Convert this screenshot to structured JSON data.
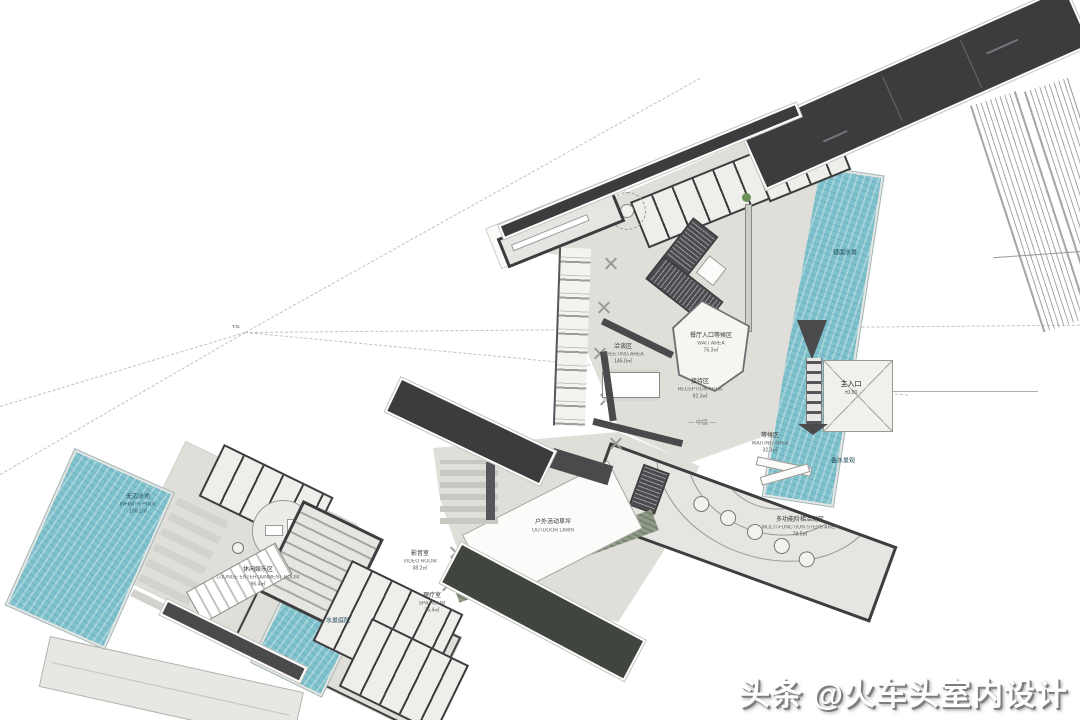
{
  "watermark": {
    "text": "头条 @火车头室内设计"
  },
  "colors": {
    "roof": "#3c3c3e",
    "wall": "#4a4a4c",
    "floor": "#e0ded9",
    "water": "#7fc1cc",
    "planting": "#8f9a87",
    "tree": "#6b9158"
  },
  "sight": {
    "point_label": "T.N."
  },
  "rooms": {
    "greeting": {
      "cn": "洽谈区",
      "en": "GREETING AREA",
      "area": "145.0㎡"
    },
    "wait": {
      "cn": "餐厅入口等候区",
      "en": "WAIT AREA",
      "area": "75.3㎡"
    },
    "reception": {
      "cn": "接待区",
      "en": "RECEPTION AREA",
      "area": "92.3㎡"
    },
    "atrium": {
      "cn": "— 中庭 —"
    },
    "entrance": {
      "cn": "主入口",
      "level": "±0.00"
    },
    "mirror_water": {
      "cn": "镜面水景"
    },
    "cascade_water": {
      "cn": "叠水景观"
    },
    "pool": {
      "cn": "无边泳池",
      "en": "INFINITY POOL",
      "area": "150.2㎡"
    },
    "lounge": {
      "cn": "休闲娱乐区",
      "en": "LOUNGE ENTERTAINMENT ROOM",
      "area": "96.4㎡"
    },
    "av_room": {
      "cn": "影音室",
      "en": "VIDEO ROOM",
      "area": "38.2㎡"
    },
    "spa": {
      "cn": "理疗室",
      "en": "SPA ROOM",
      "area": "26.4㎡"
    },
    "steps_hall": {
      "cn": "多功能阶梯活动区",
      "en": "MULTI-FUNCTION STEPS AREA",
      "area": "78.5㎡"
    },
    "waiting": {
      "cn": "等候区",
      "en": "WAITING AREA",
      "area": "32.3㎡"
    },
    "lawn": {
      "cn": "户外活动草坪",
      "en": "OUTDOOR LAWN"
    },
    "water_court": {
      "cn": "水景庭院"
    }
  }
}
